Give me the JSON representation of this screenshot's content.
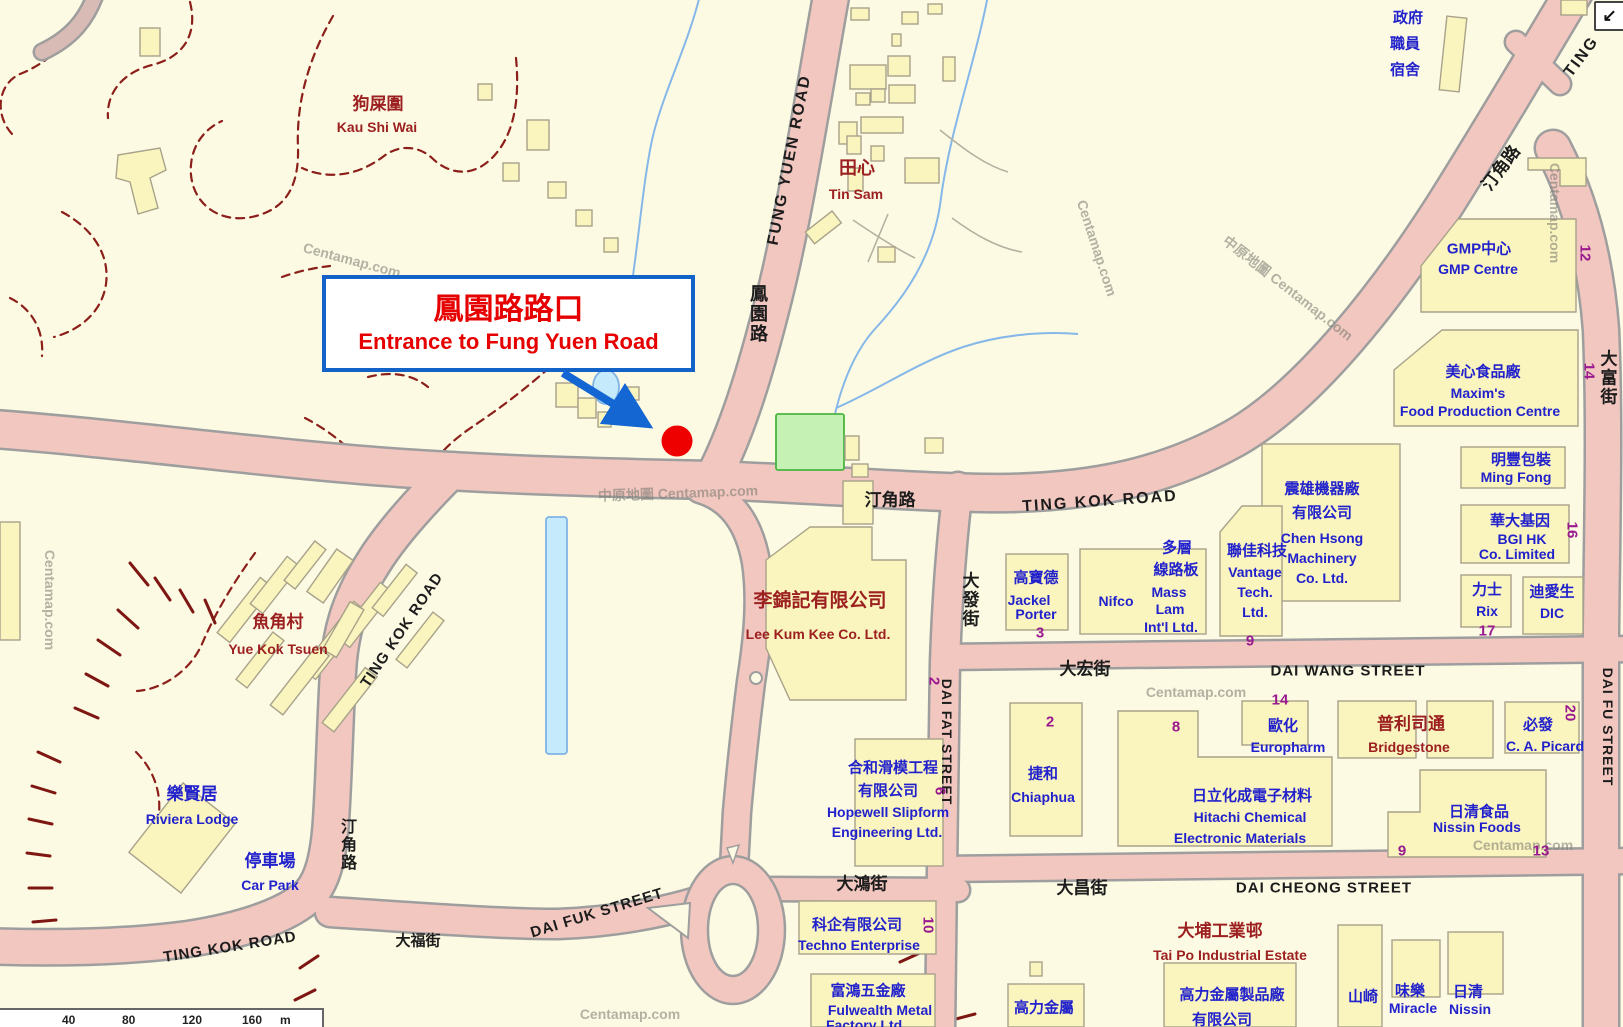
{
  "annotation": {
    "title_zh": "鳳園路路口",
    "subtitle_en": "Entrance to Fung Yuen Road"
  },
  "roads": {
    "fung_yuen_en": "FUNG YUEN ROAD",
    "fung_yuen_zh": "鳳園路",
    "ting_kok_en": "TING KOK ROAD",
    "ting_kok_zh": "汀角路",
    "ting_partial": "TING",
    "dai_fat_zh": "大發街",
    "dai_fat_en": "DAI FAT STREET",
    "dai_wang_zh": "大宏街",
    "dai_wang_en": "DAI WANG STREET",
    "dai_cheong_zh": "大昌街",
    "dai_cheong_en": "DAI CHEONG STREET",
    "dai_fu_zh": "大富街",
    "dai_fu_en": "DAI FU STREET",
    "dai_fuk_zh": "大福街",
    "dai_fuk_en": "DAI FUK STREET",
    "dai_hung_zh": "大鴻街"
  },
  "places": {
    "kau_shi_wai_zh": "狗屎圍",
    "kau_shi_wai_en": "Kau Shi Wai",
    "tin_sam_zh": "田心",
    "tin_sam_en": "Tin Sam",
    "yue_kok_tsuen_zh": "魚角村",
    "yue_kok_tsuen_en": "Yue Kok Tsuen",
    "riviera_zh": "樂賢居",
    "riviera_en": "Riviera Lodge",
    "car_park_zh": "停車場",
    "car_park_en": "Car Park",
    "govt_q1": "政府",
    "govt_q2": "職員",
    "govt_q3": "宿舍",
    "tai_po_zh": "大埔工業邨",
    "tai_po_en": "Tai Po Industrial Estate"
  },
  "buildings": {
    "gmp_zh": "GMP中心",
    "gmp_en": "GMP Centre",
    "gmp_no": "12",
    "maxims_zh": "美心食品廠",
    "maxims_en1": "Maxim's",
    "maxims_en2": "Food Production Centre",
    "maxims_no": "14",
    "ming_fong_zh": "明豐包裝",
    "ming_fong_en": "Ming Fong",
    "bgi_zh": "華大基因",
    "bgi_en1": "BGI HK",
    "bgi_en2": "Co. Limited",
    "bgi_no": "16",
    "rix_zh": "力士",
    "rix_en": "Rix",
    "rix_no": "17",
    "dic_zh": "迪愛生",
    "dic_en": "DIC",
    "chen_zh1": "震雄機器廠",
    "chen_zh2": "有限公司",
    "chen_en1": "Chen Hsong",
    "chen_en2": "Machinery",
    "chen_en3": "Co. Ltd.",
    "vantage_zh": "聯佳科技",
    "vantage_en1": "Vantage",
    "vantage_en2": "Tech.",
    "vantage_en3": "Ltd.",
    "vantage_no": "9",
    "mass_zh1": "多層",
    "mass_zh2": "線路板",
    "mass_en1": "Mass",
    "mass_en2": "Lam",
    "mass_en3": "Int'l Ltd.",
    "nifco_en": "Nifco",
    "jackel_zh": "高寶德",
    "jackel_en1": "Jackel",
    "jackel_en2": "Porter",
    "jackel_no": "3",
    "chiaphua_zh": "捷和",
    "chiaphua_en": "Chiaphua",
    "chiaphua_no": "2",
    "hitachi_zh": "日立化成電子材料",
    "hitachi_en1": "Hitachi Chemical",
    "hitachi_en2": "Electronic Materials",
    "hitachi_no": "8",
    "euro_zh": "歐化",
    "euro_en": "Europharm",
    "euro_no": "14",
    "bridgestone_zh": "普利司通",
    "bridgestone_en": "Bridgestone",
    "picard_zh": "必發",
    "picard_en": "C. A. Picard",
    "picard_no": "20",
    "nissin_zh": "日清食品",
    "nissin_en": "Nissin Foods",
    "nissin_no1": "9",
    "nissin_no2": "13",
    "lkk_zh": "李錦記有限公司",
    "lkk_en": "Lee Kum Kee Co. Ltd.",
    "lkk_no": "2",
    "hopewell_zh1": "合和滑模工程",
    "hopewell_zh2": "有限公司",
    "hopewell_en1": "Hopewell Slipform",
    "hopewell_en2": "Engineering Ltd.",
    "hopewell_no": "6",
    "techno_zh": "科企有限公司",
    "techno_en": "Techno Enterprise",
    "techno_no": "10",
    "fulwealth_zh": "富鴻五金廠",
    "fulwealth_en1": "Fulwealth Metal",
    "fulwealth_en2": "Factory Ltd.",
    "kolik_zh": "高力金屬",
    "kolik_f_zh1": "高力金屬製品廠",
    "kolik_f_zh2": "有限公司",
    "yamazaki_zh": "山崎",
    "miracle_zh": "味樂",
    "miracle_en": "Miracle",
    "nissin2_zh": "日清",
    "nissin2_en": "Nissin"
  },
  "watermarks": {
    "short": "Centamap.com",
    "long": "中原地圖 Centamap.com"
  },
  "scalebar": {
    "t1": "40",
    "t2": "80",
    "t3": "120",
    "t4": "160",
    "unit": "m"
  },
  "controls": {
    "pan": "↙"
  },
  "colors": {
    "accent_blue": "#1467D2",
    "marker_red": "#EE0000",
    "road_pink": "#F2C7BF",
    "building_yellow": "#FAF4BE",
    "label_blue": "#2222CC",
    "label_dark_red": "#9C2020",
    "number_purple": "#99198F",
    "water_blue": "#C5EAFB",
    "park_green": "#C6F1B5"
  }
}
